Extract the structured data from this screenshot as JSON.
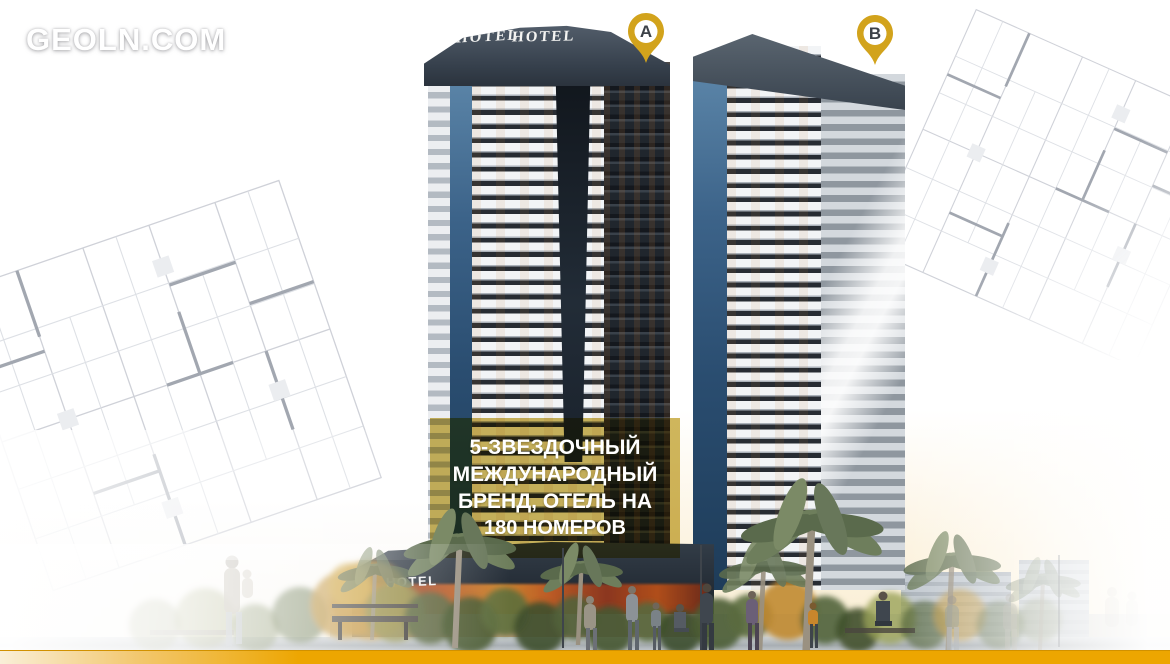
{
  "site": {
    "logo": "GEOLN.COM"
  },
  "markers": {
    "a": "A",
    "b": "B"
  },
  "signs": {
    "rooftop_left": "HOTEL",
    "rooftop_right": "HOTEL",
    "street": "HOTEL"
  },
  "overlay": {
    "line1": "5-ЗВЕЗДОЧНЫЙ",
    "line2": "МЕЖДУНАРОДНЫЙ",
    "line3": "БРЕНД, ОТЕЛЬ НА",
    "line4": "180 НОМЕРОВ"
  },
  "colors": {
    "pin_gold": "#D2A31C",
    "overlay_yellow": "#CDB354",
    "bottom_bar_amber": "#EDA601",
    "glass_blue": "#3E6C95",
    "facade_dark": "#272C33",
    "facade_light": "#F2F4F6",
    "cap_slate": "#39434F"
  }
}
